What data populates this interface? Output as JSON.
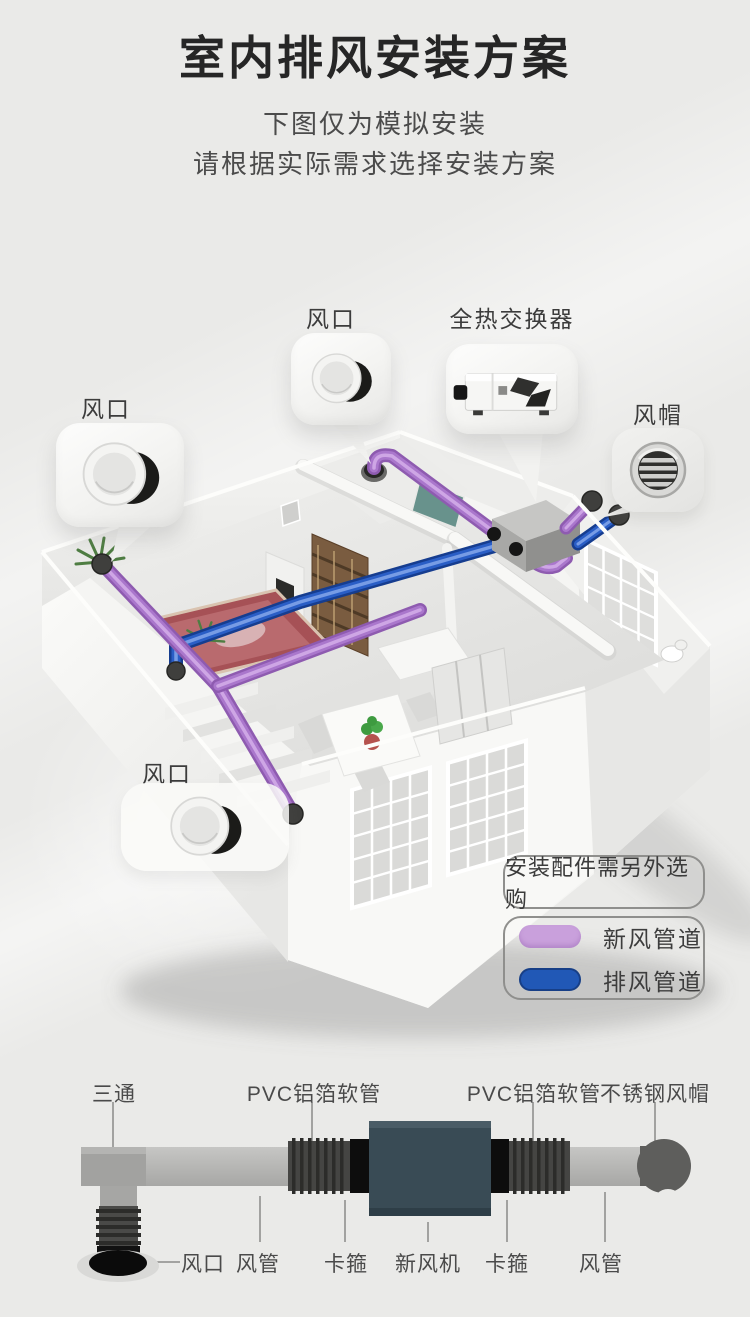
{
  "page": {
    "background": "#eaeae8",
    "title": "室内排风安装方案",
    "subtitle_line1": "下图仅为模拟安装",
    "subtitle_line2": "请根据实际需求选择安装方案"
  },
  "callouts": {
    "outlet_top": {
      "label": "风口"
    },
    "exchanger": {
      "label": "全热交换器"
    },
    "outlet_left": {
      "label": "风口"
    },
    "windcap": {
      "label": "风帽"
    },
    "outlet_bottom": {
      "label": "风口"
    }
  },
  "legend": {
    "note": "安装配件需另外选购",
    "items": [
      {
        "label": "新风管道",
        "color": "#c9a0dc"
      },
      {
        "label": "排风管道",
        "color": "#2158b6"
      }
    ]
  },
  "diagram": {
    "top_labels": [
      {
        "label": "三通"
      },
      {
        "label": "PVC铝箔软管"
      },
      {
        "label": "PVC铝箔软管"
      },
      {
        "label": "不锈钢风帽"
      }
    ],
    "bottom_labels": [
      {
        "label": "风口"
      },
      {
        "label": "风管"
      },
      {
        "label": "卡箍"
      },
      {
        "label": "新风机"
      },
      {
        "label": "卡箍"
      },
      {
        "label": "风管"
      }
    ]
  },
  "colors": {
    "fresh_air_duct_purple": "#c9a0dc",
    "exhaust_duct_blue": "#2158b6",
    "pipe_purple": "#aa77cc",
    "pipe_blue": "#2a5ec6",
    "machine_body": "#394b55",
    "title_text": "#262626",
    "label_text": "#3c3c3c"
  }
}
